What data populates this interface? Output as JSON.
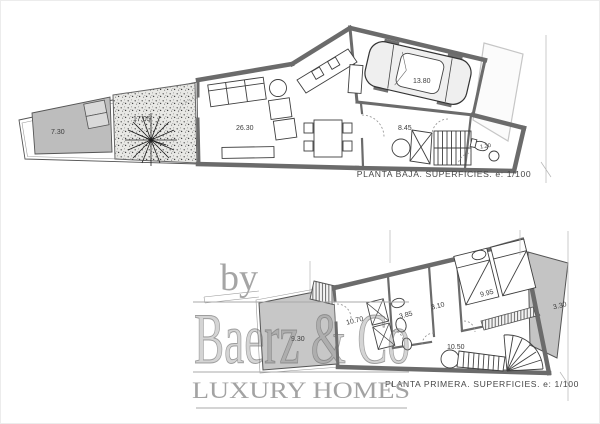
{
  "watermark": {
    "by": "by",
    "brand": "Baerz & Co",
    "tagline": "LUXURY HOMES",
    "color": "#a3a3a3"
  },
  "floors": [
    {
      "id": "planta-baja",
      "title": "PLANTA BAJA. SUPERFICIES. e: 1/100",
      "areas": {
        "pool": "7.30",
        "terrace": "17.05",
        "living": "26.30",
        "garage": "13.80",
        "hall": "8.45",
        "bath": "1.20"
      }
    },
    {
      "id": "planta-primera",
      "title": "PLANTA PRIMERA. SUPERFICIES. e: 1/100",
      "areas": {
        "terrace": "9.30",
        "bedroom2": "10.70",
        "bath": "3.85",
        "corridor": "3.10",
        "bedroom1": "9.95",
        "landing": "10.50",
        "balcony": "3.30"
      }
    }
  ],
  "colors": {
    "wall": "#6b6b6b",
    "poolShade": "#bdbdbd",
    "terraceShade": "#c7c7c7",
    "balconyShade": "#c4c4c4",
    "label": "#3c3c3c"
  }
}
